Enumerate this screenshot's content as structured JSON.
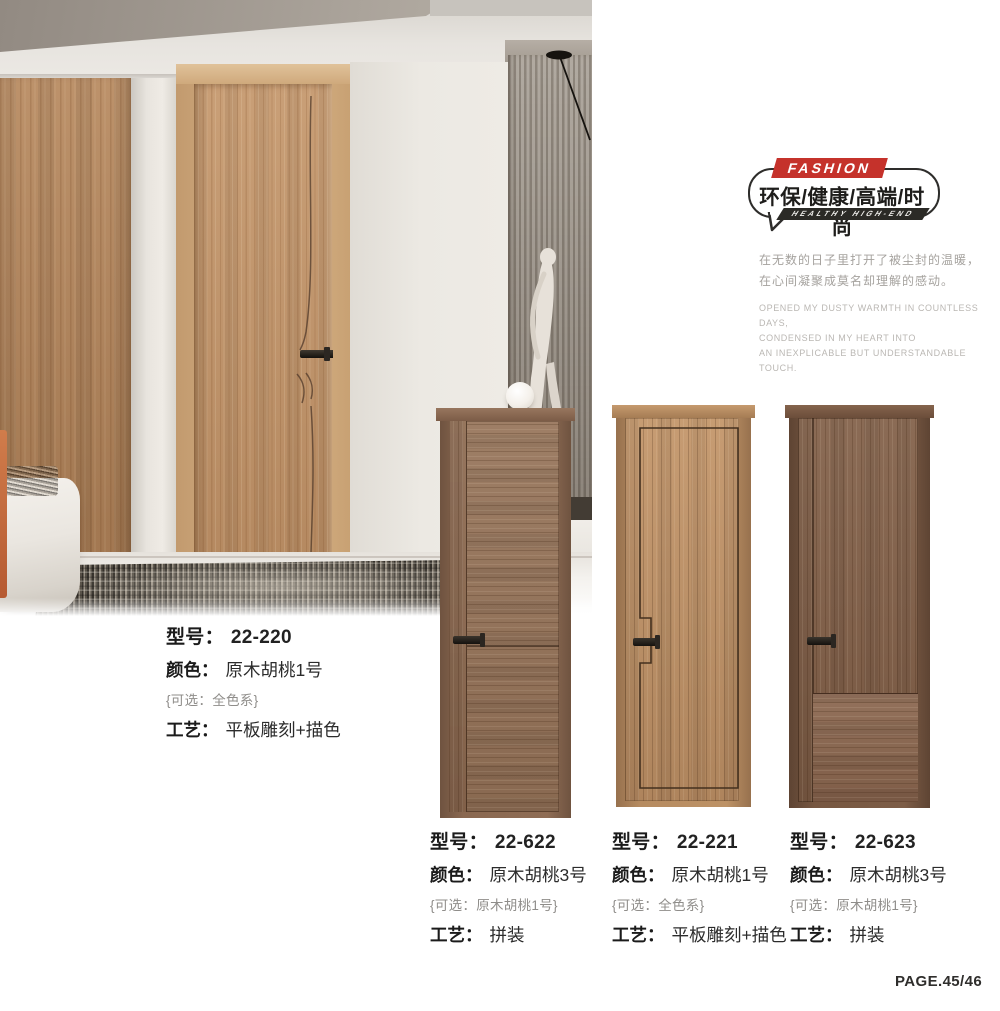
{
  "page": {
    "number": "PAGE.45/46"
  },
  "badge": {
    "fashion_label": "FASHION",
    "headline": "环保/健康/高端/时尚",
    "subline": "HEALTHY HIGH-END",
    "red": "#c5322b",
    "dark": "#2b2a26"
  },
  "intro": {
    "cn": [
      "在无数的日子里打开了被尘封的温暖，",
      "在心间凝聚成莫名却理解的感动。"
    ],
    "en": [
      "OPENED MY DUSTY WARMTH IN COUNTLESS DAYS,",
      "CONDENSED IN MY HEART INTO",
      "AN INEXPLICABLE BUT UNDERSTANDABLE TOUCH."
    ]
  },
  "labels": {
    "model": "型号：",
    "color": "颜色：",
    "craft": "工艺："
  },
  "products": [
    {
      "model": "22-220",
      "color": "原木胡桃1号",
      "optional": "{可选：全色系}",
      "craft": "平板雕刻+描色"
    },
    {
      "model": "22-622",
      "color": "原木胡桃3号",
      "optional": "{可选：原木胡桃1号}",
      "craft": "拼装"
    },
    {
      "model": "22-221",
      "color": "原木胡桃1号",
      "optional": "{可选：全色系}",
      "craft": "平板雕刻+描色"
    },
    {
      "model": "22-623",
      "color": "原木胡桃3号",
      "optional": "{可选：原木胡桃1号}",
      "craft": "拼装"
    }
  ],
  "colors": {
    "scene_wood_wall": "#b5885f",
    "scene_door": "#c3966c",
    "door_22_622": "#96755c",
    "door_22_221": "#c2956a",
    "door_22_623": "#81604a",
    "rug_dark": "#34302a"
  }
}
